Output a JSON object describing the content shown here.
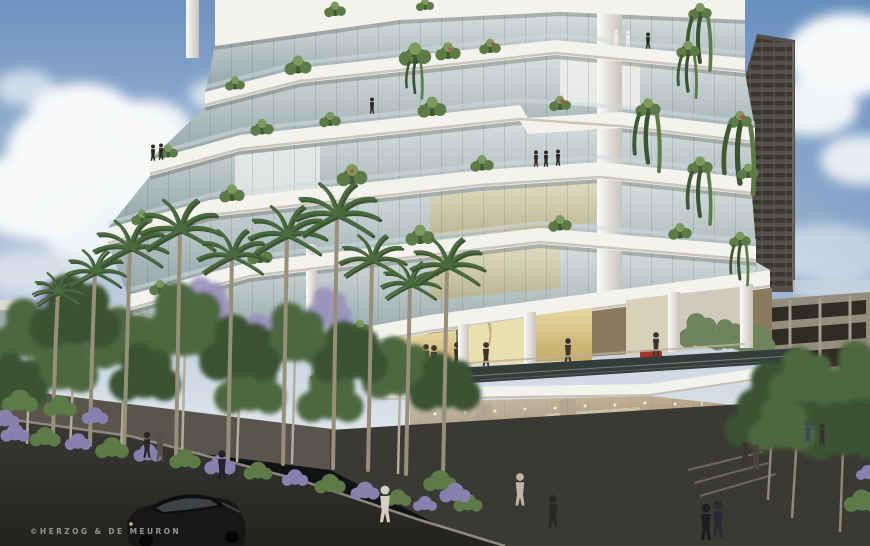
{
  "image": {
    "kind": "architectural-rendering",
    "subject": "terraced white residential tower with tropical planting, street scene"
  },
  "watermark": {
    "text": "©HERZOG & DE MEURON"
  },
  "palette": {
    "sky_top": "#6e93c1",
    "sky_mid": "#a3b8d2",
    "sky_low": "#dde4ea",
    "sky_deep": "#5d87bb",
    "cloud": "#f7f9fa",
    "slab": "#f4f2ec",
    "slab_shade": "#d8d5cc",
    "soffit": "#b8b5ab",
    "glass_hi": "#d7dfdf",
    "glass_lo": "#93a4a8",
    "curtain": "#eef0ec",
    "tower": "#53504a",
    "tower_band": "#34322d",
    "garage": "#948c7d",
    "garage_dark": "#2f2b25",
    "lobby_bg": "#8a7a5f",
    "lobby_gold": "#e6d8a2",
    "lobby_gold_deep": "#c2a963",
    "retail_warm": "#b3a183",
    "retail_deep": "#6e5f49",
    "pool": "#323d3c",
    "plant_dark": "#3f5a33",
    "plant_mid": "#5d7b46",
    "plant_light": "#7d9a5e",
    "palm_trunk": "#988f7b",
    "frond": "#4a6a40",
    "frond_dark": "#3a5432",
    "tree": "#4d6840",
    "tree_dark": "#3a5231",
    "tree_bg": "#6f835c",
    "jacaranda": "#9a92bd",
    "road": "#2b2a27",
    "sidewalk": "#59554d",
    "plaza": "#3b3934",
    "curb": "#8d897f",
    "flower": "#8781b0",
    "flower_red": "#b3574a",
    "car": "#181716",
    "red_car": "#a23526",
    "figure": "#2c2924",
    "figure_light": "#d5cfc2",
    "watermark": "#949494"
  }
}
